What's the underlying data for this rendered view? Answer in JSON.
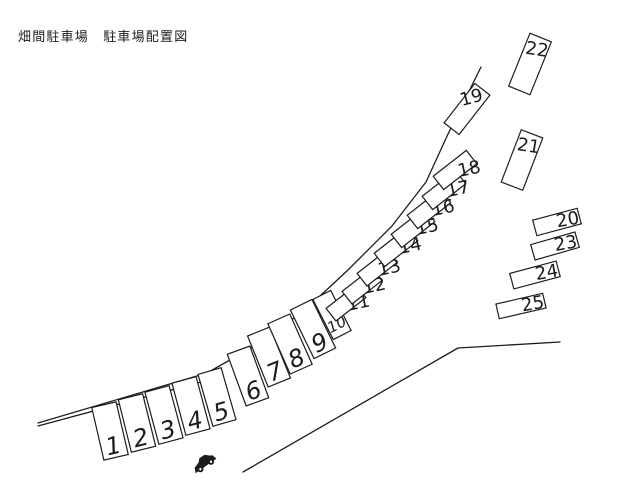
{
  "title": "畑間駐車場　駐車場配置図",
  "canvas": {
    "width": 640,
    "height": 480
  },
  "colors": {
    "background": "#ffffff",
    "line": "#1c1c1c",
    "text": "#1c1c1c"
  },
  "map": {
    "roads": [
      {
        "name": "road-edge-upper",
        "points": [
          [
            38,
            423
          ],
          [
            207,
            373
          ],
          [
            258,
            344
          ],
          [
            305,
            310
          ],
          [
            348,
            270
          ],
          [
            392,
            226
          ],
          [
            426,
            182
          ],
          [
            448,
            134
          ],
          [
            481,
            67
          ]
        ]
      },
      {
        "name": "road-edge-inner",
        "points": [
          [
            38,
            426
          ],
          [
            212,
            379
          ]
        ]
      },
      {
        "name": "road-edge-lower",
        "points": [
          [
            243,
            472
          ],
          [
            458,
            348
          ],
          [
            560,
            342
          ]
        ]
      }
    ],
    "spaces": [
      {
        "n": "1",
        "cx": 110,
        "cy": 431,
        "w": 25,
        "h": 54,
        "rot": -13,
        "anchor": "bottom",
        "fs": 24
      },
      {
        "n": "2",
        "cx": 137,
        "cy": 423,
        "w": 25,
        "h": 54,
        "rot": -14,
        "anchor": "bottom",
        "fs": 24
      },
      {
        "n": "3",
        "cx": 164,
        "cy": 415,
        "w": 25,
        "h": 54,
        "rot": -15,
        "anchor": "bottom",
        "fs": 24
      },
      {
        "n": "4",
        "cx": 191,
        "cy": 406,
        "w": 25,
        "h": 54,
        "rot": -15,
        "anchor": "bottom",
        "fs": 24
      },
      {
        "n": "5",
        "cx": 217,
        "cy": 397,
        "w": 24,
        "h": 54,
        "rot": -16,
        "anchor": "bottom",
        "fs": 24
      },
      {
        "n": "6",
        "cx": 248,
        "cy": 376,
        "w": 24,
        "h": 55,
        "rot": -20,
        "anchor": "bottom",
        "fs": 24
      },
      {
        "n": "7",
        "cx": 269,
        "cy": 357,
        "w": 24,
        "h": 55,
        "rot": -22,
        "anchor": "bottom",
        "fs": 24
      },
      {
        "n": "8",
        "cx": 290,
        "cy": 344,
        "w": 24,
        "h": 55,
        "rot": -24,
        "anchor": "bottom",
        "fs": 24
      },
      {
        "n": "9",
        "cx": 313,
        "cy": 329,
        "w": 24,
        "h": 54,
        "rot": -26,
        "anchor": "bottom",
        "fs": 24
      },
      {
        "n": "10",
        "cx": 332,
        "cy": 315,
        "w": 20,
        "h": 45,
        "rot": -27,
        "anchor": "bottom",
        "fs": 15
      },
      {
        "n": "11",
        "cx": 346,
        "cy": 303,
        "w": 38,
        "h": 16,
        "rot": -38,
        "anchor": "corner",
        "fs": 18
      },
      {
        "n": "12",
        "cx": 362,
        "cy": 286,
        "w": 38,
        "h": 16,
        "rot": -38,
        "anchor": "corner",
        "fs": 18
      },
      {
        "n": "13",
        "cx": 377,
        "cy": 268,
        "w": 38,
        "h": 16,
        "rot": -38,
        "anchor": "corner",
        "fs": 18
      },
      {
        "n": "14",
        "cx": 396,
        "cy": 247,
        "w": 42,
        "h": 17,
        "rot": -38,
        "anchor": "corner",
        "fs": 18
      },
      {
        "n": "15",
        "cx": 413,
        "cy": 228,
        "w": 42,
        "h": 17,
        "rot": -38,
        "anchor": "corner",
        "fs": 18
      },
      {
        "n": "16",
        "cx": 429,
        "cy": 209,
        "w": 42,
        "h": 17,
        "rot": -38,
        "anchor": "corner",
        "fs": 18
      },
      {
        "n": "17",
        "cx": 444,
        "cy": 190,
        "w": 42,
        "h": 17,
        "rot": -38,
        "anchor": "corner",
        "fs": 18
      },
      {
        "n": "18",
        "cx": 455,
        "cy": 170,
        "w": 42,
        "h": 17,
        "rot": -38,
        "anchor": "corner",
        "fs": 18
      },
      {
        "n": "19",
        "cx": 467,
        "cy": 109,
        "w": 50,
        "h": 19,
        "rot": -52,
        "anchor": "corner",
        "fs": 18,
        "lox": 12,
        "loy": -4,
        "lrot": -15
      },
      {
        "n": "20",
        "cx": 557,
        "cy": 222,
        "w": 46,
        "h": 16,
        "rot": -15,
        "anchor": "right",
        "fs": 18
      },
      {
        "n": "21",
        "cx": 522,
        "cy": 160,
        "w": 23,
        "h": 56,
        "rot": 21,
        "anchor": "top",
        "fs": 18
      },
      {
        "n": "22",
        "cx": 530,
        "cy": 64,
        "w": 23,
        "h": 57,
        "rot": 22,
        "anchor": "top",
        "fs": 18
      },
      {
        "n": "23",
        "cx": 555,
        "cy": 246,
        "w": 46,
        "h": 16,
        "rot": -16,
        "anchor": "right",
        "fs": 18
      },
      {
        "n": "24",
        "cx": 535,
        "cy": 275,
        "w": 48,
        "h": 16,
        "rot": -15,
        "anchor": "right",
        "fs": 18
      },
      {
        "n": "25",
        "cx": 521,
        "cy": 306,
        "w": 48,
        "h": 15,
        "rot": -13,
        "anchor": "right",
        "fs": 18
      }
    ],
    "car": {
      "cx": 204,
      "cy": 463,
      "rot": -35
    }
  }
}
